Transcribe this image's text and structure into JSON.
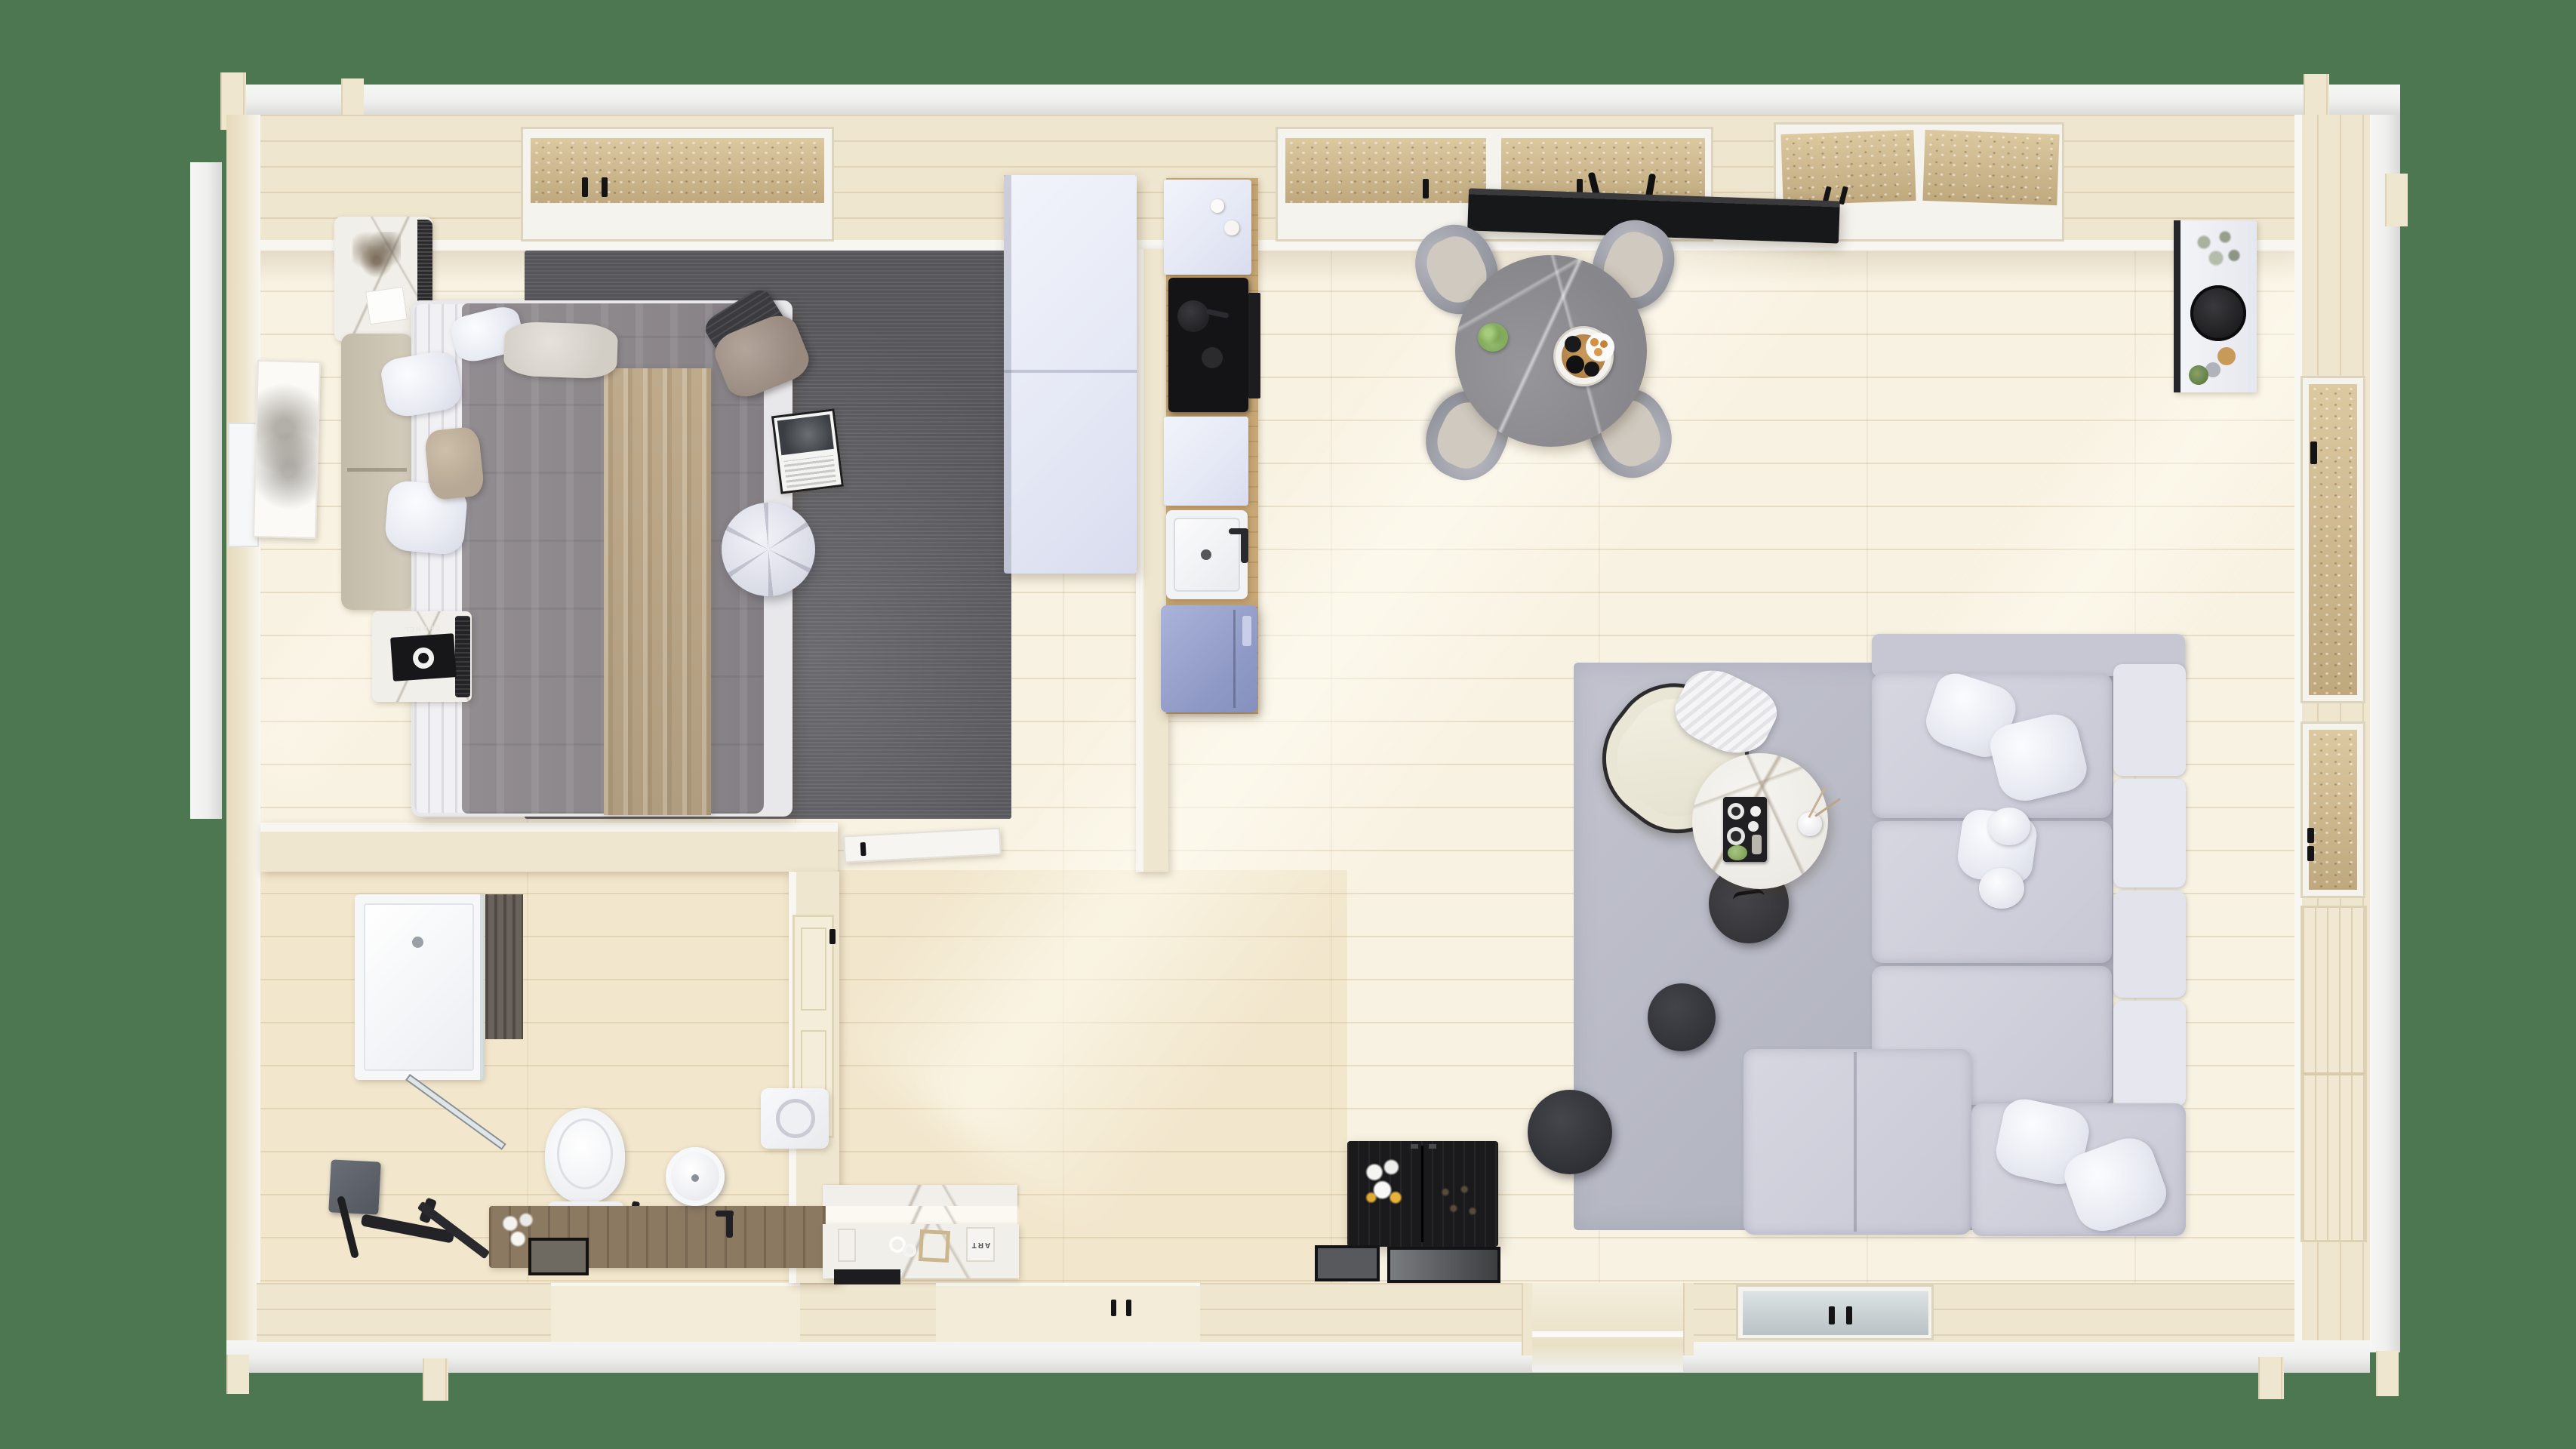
{
  "scene": {
    "description": "Top-down 3D dollhouse render of a one-room log cabin floor plan with bedroom, bathroom, kitchen, dining and living areas",
    "background_color": "#4c7750"
  },
  "decor_text": {
    "book_spine": "ART",
    "fashion_book": "CHANEL"
  },
  "palette": {
    "green": "#4c7750",
    "beam": "#eff0ee",
    "beamShadow": "#d8d9d6",
    "wallWood": "#efe6cf",
    "wallWoodDark": "#e2d4b4",
    "floor": "#f8f2e2",
    "sill": "#f4f3ee",
    "rugBedroom": "#55555a",
    "rugLiving": "#babcc8",
    "duvetGray": "#8f8a8e",
    "sheetWhite": "#f1f0f3",
    "throwTan": "#b5a184",
    "headboardBeige": "#cfc8b8",
    "pillowDark": "#3b3b3f",
    "pillowTaupe": "#a2948a",
    "cabinetWhite": "#e9ecf7",
    "fridgeBlue": "#9aa4cf",
    "counterWood": "#c9a876",
    "cooktopBlack": "#141416",
    "tableMarbleGray": "#8e8d90",
    "chairGray": "#9fa2ac",
    "chairSeat": "#cfc9bf",
    "sofaGray": "#cdced9",
    "sofaBack": "#e4e5ed",
    "armchairCream": "#eae6d6",
    "sideTableDark": "#3a3a3e",
    "poufDark": "#36373b",
    "sideboardBlack": "#1a1a1c",
    "benchWood": "#8b7962",
    "slatDark": "#6a635c",
    "showerHeadGray": "#5b5f66",
    "toiletWhite": "#f4f5f7",
    "plantGreen": "#8fb86a",
    "flowerYellow": "#e8b33a",
    "glassMottledBase": "#bfa87e",
    "patioGlass": "#c4cdd0"
  },
  "rooms": {
    "bedroom": [
      "double-bed",
      "headboard",
      "nightstand",
      "area-rug-dark",
      "wardrobe",
      "round-pouf",
      "magazine",
      "art-frame",
      "foot-chest"
    ],
    "kitchen": [
      "upper-cabinet",
      "cooktop",
      "sink",
      "fridge",
      "counter"
    ],
    "dining": [
      "round-marble-table",
      "four-chairs",
      "ceiling-panel-light",
      "serving-tray",
      "plant"
    ],
    "living": [
      "corner-sofa",
      "armchair",
      "marble-coffee-table",
      "dark-side-table",
      "poufs",
      "area-rug-light",
      "black-sideboard",
      "flower-vase"
    ],
    "bathroom": [
      "shower",
      "rain-shower-head",
      "toilet",
      "wood-bench",
      "round-sink",
      "washer"
    ],
    "hallway": [
      "marble-console",
      "decor-books",
      "trays"
    ]
  }
}
